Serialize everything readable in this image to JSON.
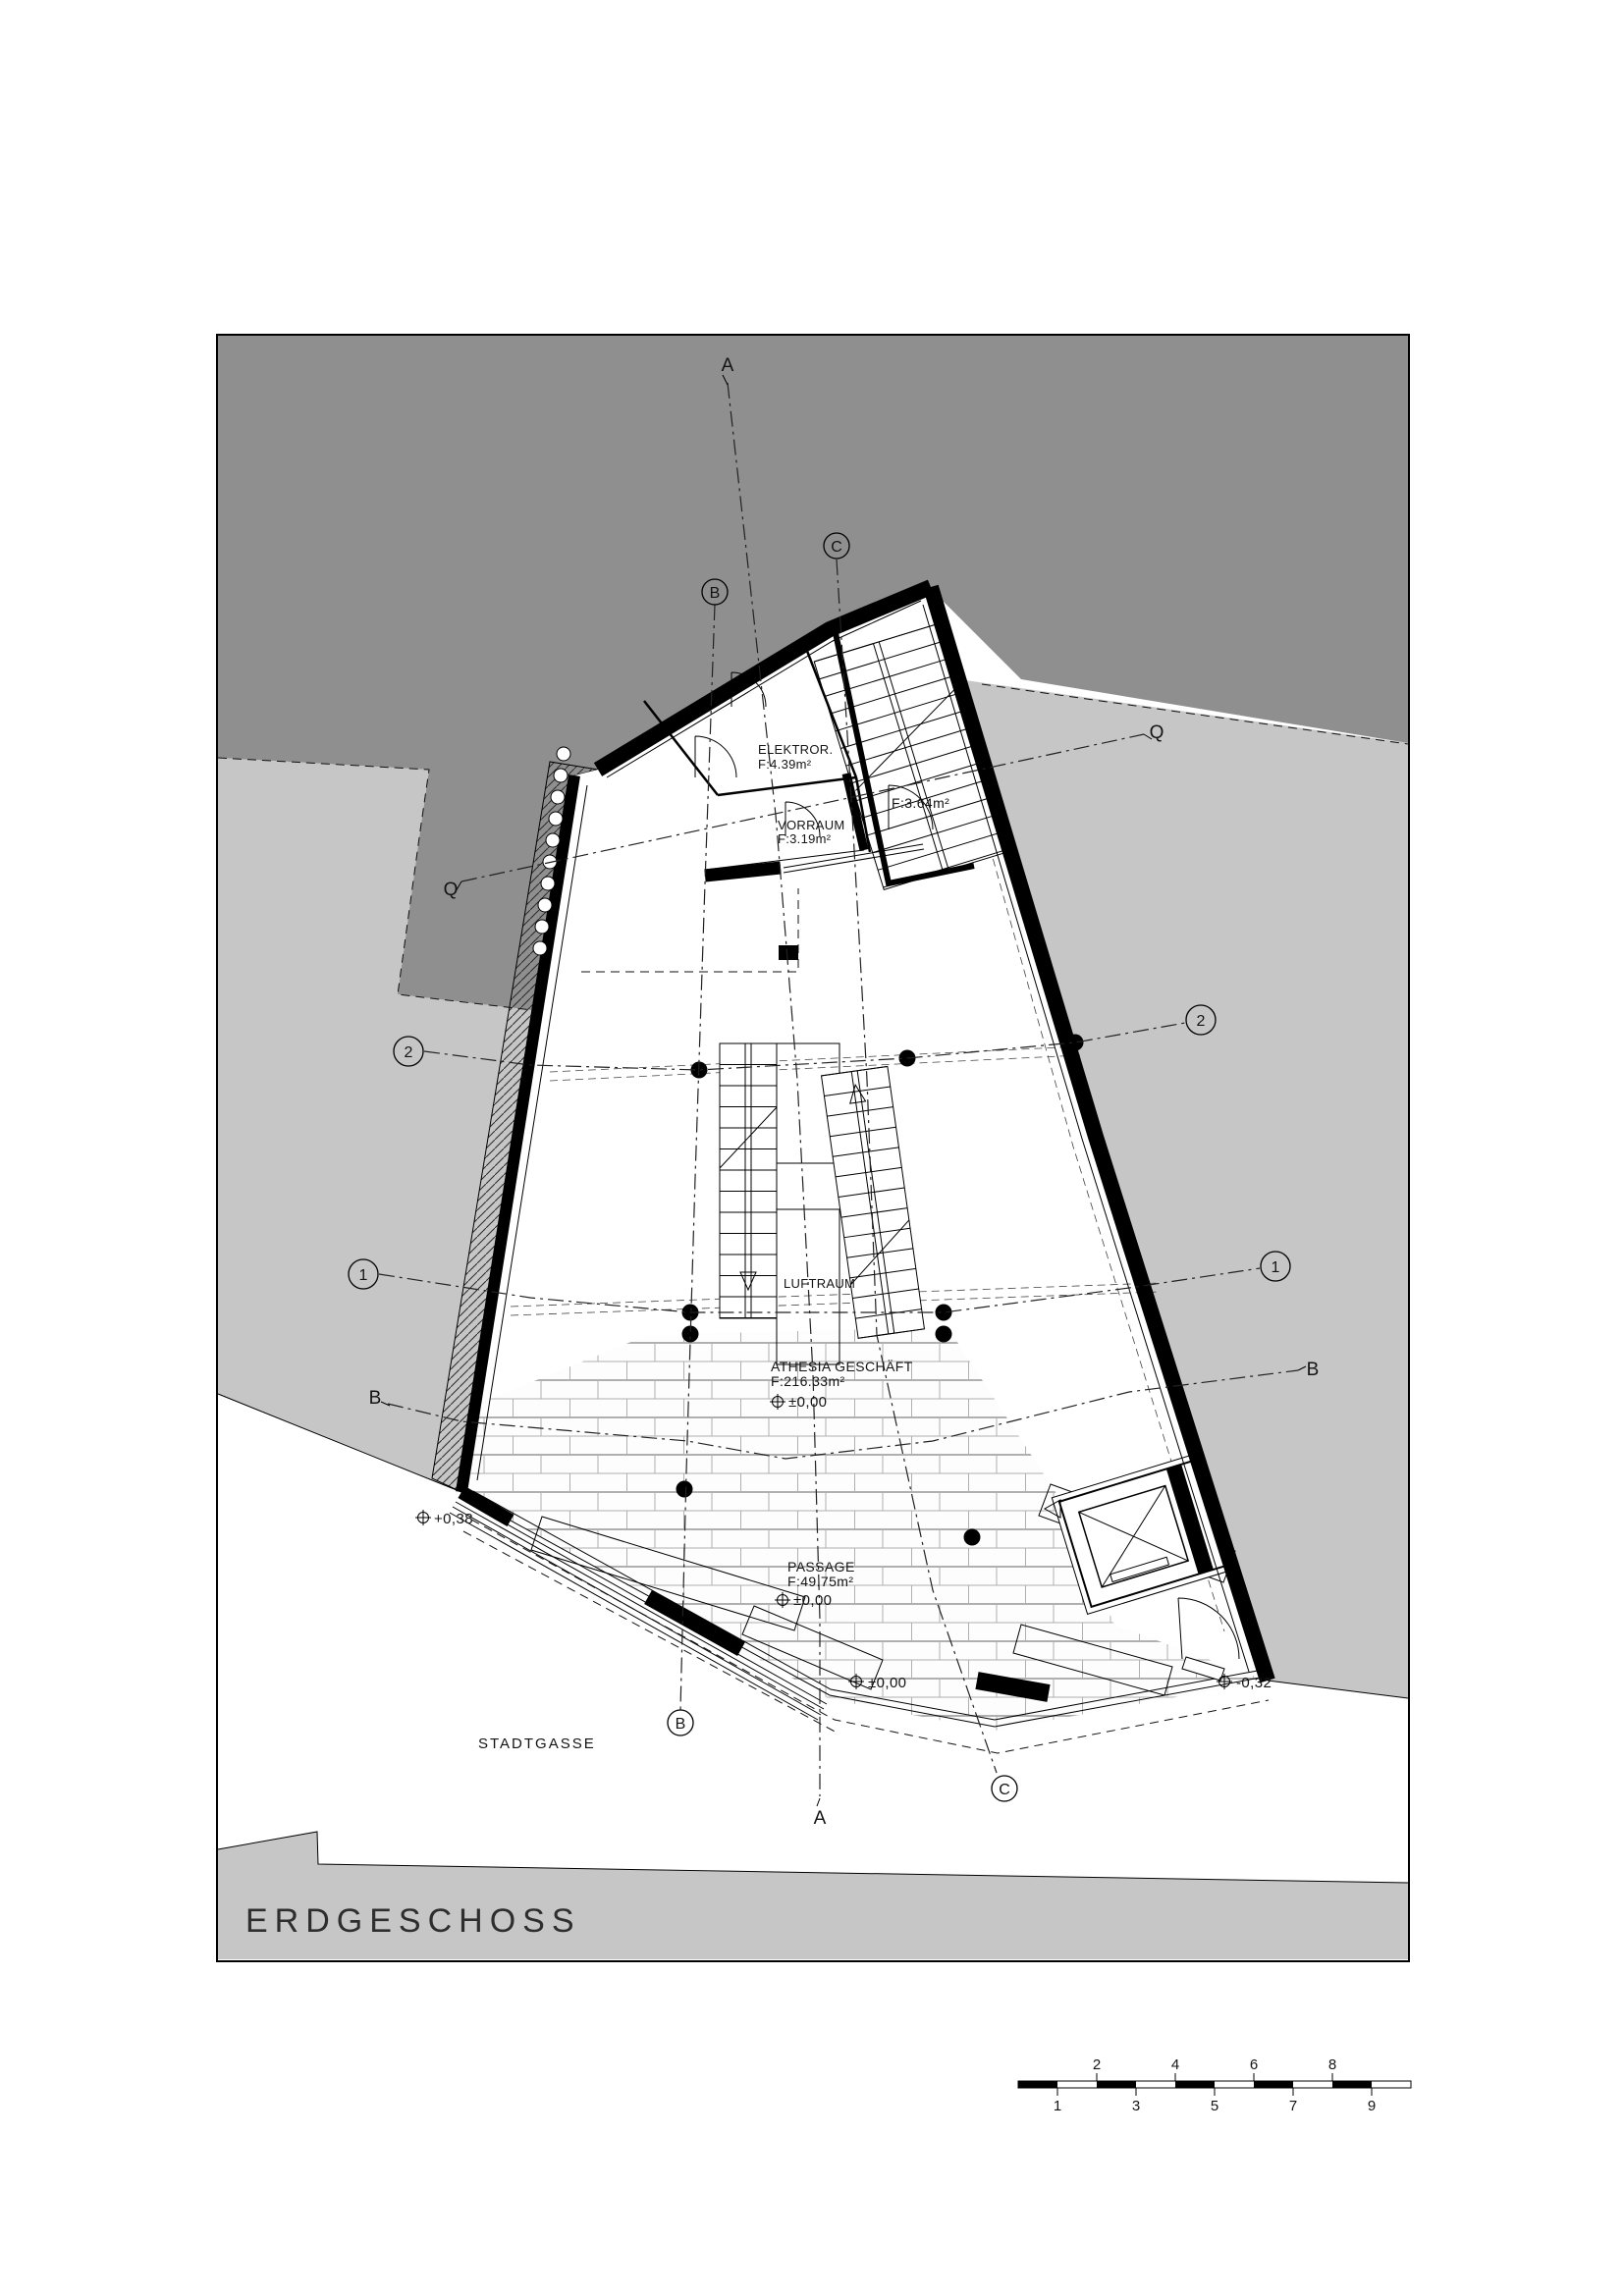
{
  "colors": {
    "dark_gray": "#8f8f8f",
    "light_gray": "#c6c6c6",
    "paper": "#ffffff",
    "ink": "#000000"
  },
  "title_block": {
    "floor_label": "ERDGESCHOSS"
  },
  "rooms": {
    "stairwell_top": {
      "area": "F:3.64m²"
    },
    "elektror": {
      "name": "ELEKTROR.",
      "area": "F:4.39m²"
    },
    "vorraum": {
      "name": "VORRAUM",
      "area": "F:3.19m²"
    },
    "luftraum": {
      "name": "LUFTRAUM"
    },
    "athesia": {
      "name": "ATHESIA GESCHÄFT",
      "area": "F:216.33m²",
      "level": "±0,00"
    },
    "passage": {
      "name": "PASSAGE",
      "area": "F:49.75m²",
      "level": "±0,00"
    }
  },
  "site": {
    "street_name": "STADTGASSE"
  },
  "levels": {
    "sw_corner": "+0,38",
    "front_center": "±0,00",
    "se_corner": "-0,32"
  },
  "grid_markers": {
    "section_a": "A",
    "section_b": "B",
    "section_c": "C",
    "axis_q": "Q",
    "axis_1": "1",
    "axis_2": "2"
  },
  "scale_bar": {
    "labels_above": [
      "2",
      "4",
      "6",
      "8"
    ],
    "labels_below": [
      "1",
      "3",
      "5",
      "7",
      "9"
    ]
  }
}
